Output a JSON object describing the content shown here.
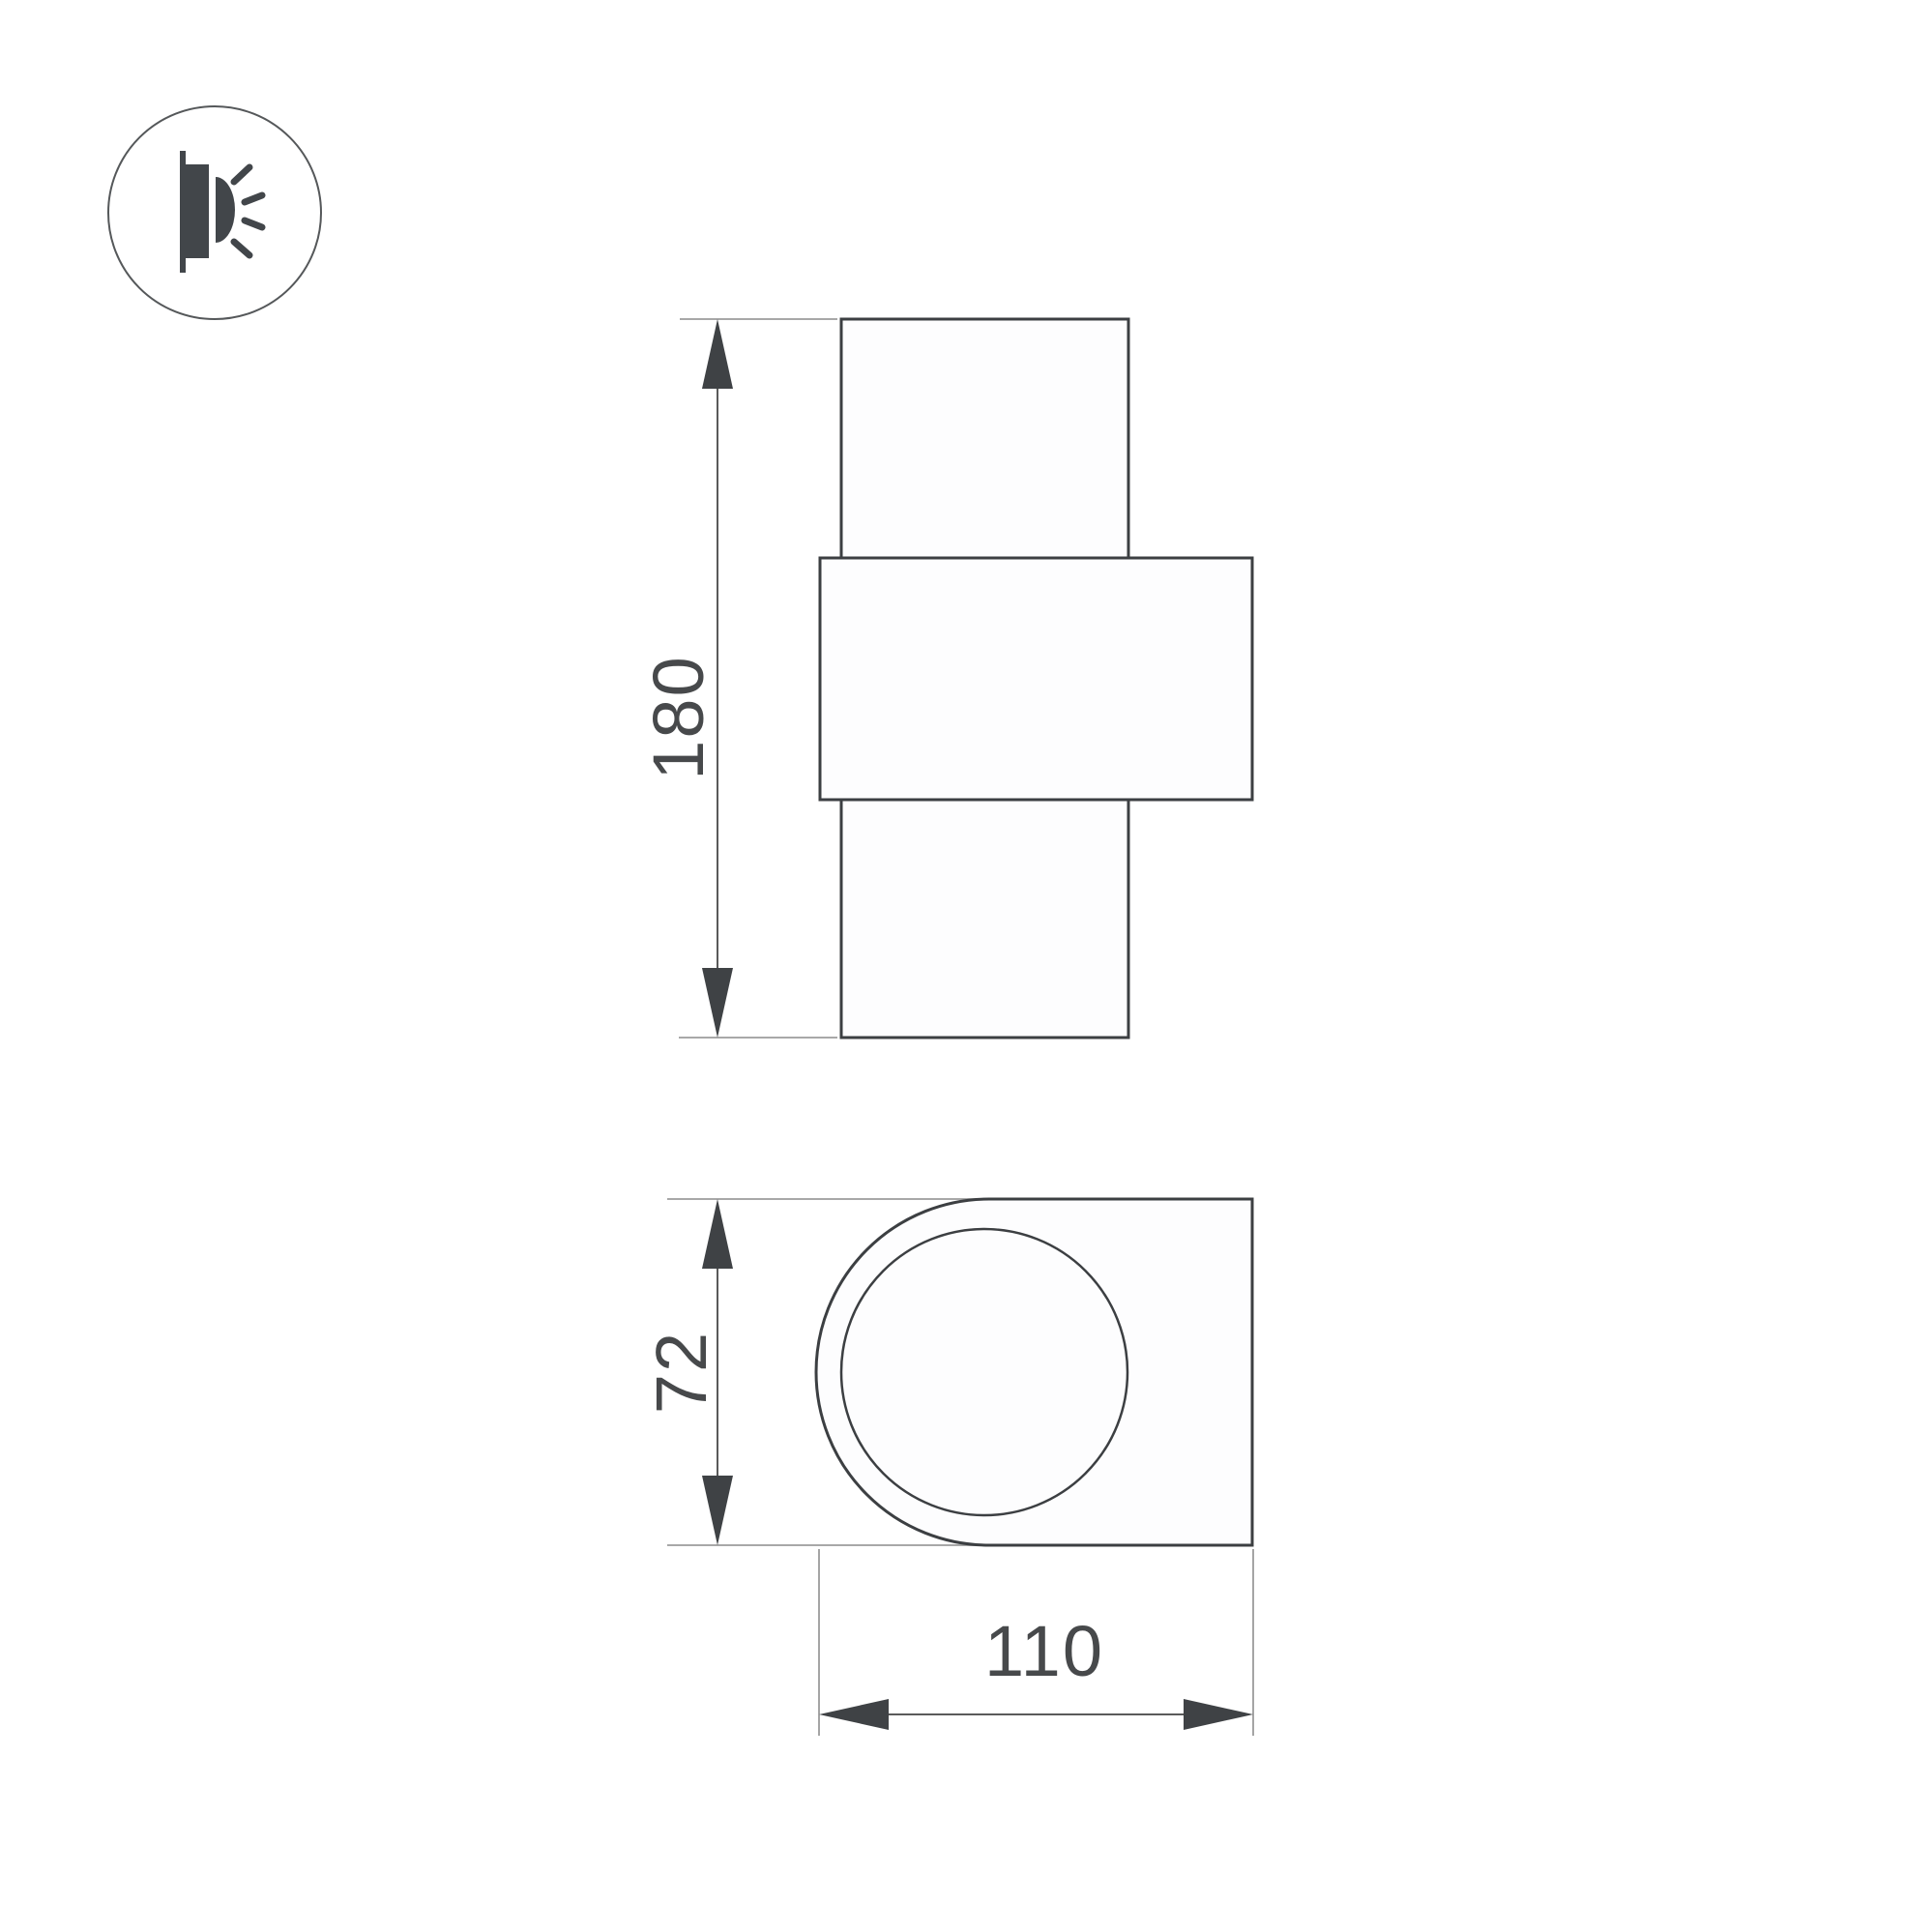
{
  "page": {
    "background": "#ffffff"
  },
  "icon": {
    "name": "wall-light-side-emission-icon"
  },
  "views": {
    "front": {
      "height_dimension": {
        "value": "180"
      }
    },
    "side": {
      "depth_dimension": {
        "value": "72"
      },
      "width_dimension": {
        "value": "110"
      }
    }
  },
  "colors": {
    "background": "#ffffff",
    "body_stroke": "#3c3f42",
    "fill": "#fdfdfe",
    "extension_line": "#9b9b9b",
    "dimension_line": "#5a5a5a",
    "arrow_fill": "#3f4245",
    "text": "#47494b",
    "icon_stroke": "#55585a",
    "icon_glyph": "#42464a"
  }
}
